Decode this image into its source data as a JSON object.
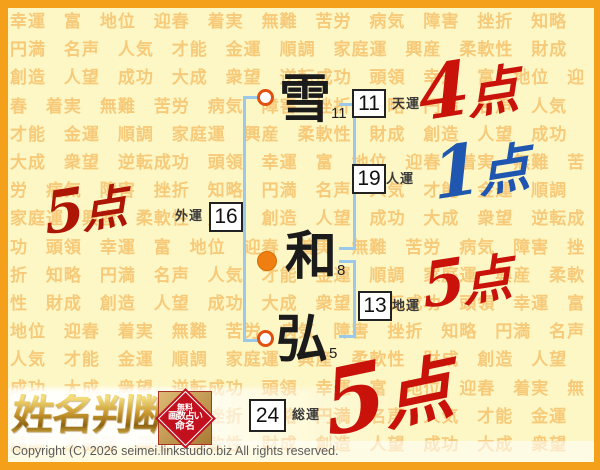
{
  "colors": {
    "frame_orange": "#F5A01B",
    "background_yellow": "#FDF7C5",
    "pattern_orange": "#F2A63C",
    "bracket_blue": "#9CC9E9",
    "marker_orange": "#EE7F10",
    "score_red": "#C8120A",
    "score_dark_red": "#AD1505",
    "score_blue": "#1E56B0",
    "badge_red": "#C3101E"
  },
  "background_words": [
    "幸運",
    "富",
    "地位",
    "迎春",
    "着実",
    "無難",
    "苦労",
    "病気",
    "障害",
    "挫折",
    "知略",
    "円満",
    "名声",
    "人気",
    "才能",
    "金運",
    "順調",
    "家庭運",
    "興産",
    "柔軟性",
    "財成",
    "創造",
    "人望",
    "成功",
    "大成",
    "衆望",
    "逆転成功",
    "頭領"
  ],
  "name_chart": {
    "characters": [
      {
        "char": "雪",
        "strokes": "11"
      },
      {
        "char": "和",
        "strokes": "8"
      },
      {
        "char": "弘",
        "strokes": "5"
      }
    ],
    "fortunes": [
      {
        "label": "天運",
        "value": "11",
        "score_num": "4",
        "score_unit": "点"
      },
      {
        "label": "人運",
        "value": "19",
        "score_num": "1",
        "score_unit": "点"
      },
      {
        "label": "外運",
        "value": "16",
        "score_num": "5",
        "score_unit": "点"
      },
      {
        "label": "地運",
        "value": "13",
        "score_num": "5",
        "score_unit": "点"
      },
      {
        "label": "総運",
        "value": "24",
        "score_num": "5",
        "score_unit": "点"
      }
    ]
  },
  "logo": {
    "title": "姓名判断",
    "badge": {
      "line1": "無料",
      "line2": "画数占い",
      "line3": "命名"
    }
  },
  "footer": {
    "copyright": "Copyright (C) 2026 seimei.linkstudio.biz All rights reserved."
  }
}
